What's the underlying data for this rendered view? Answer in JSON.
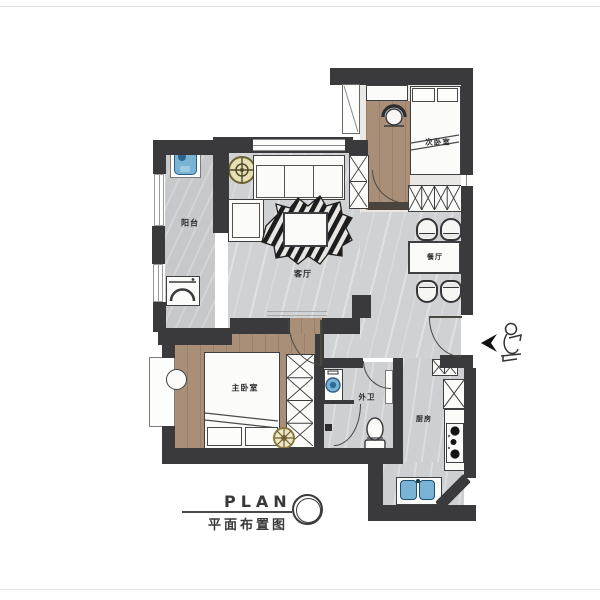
{
  "document": {
    "title": "PLAN",
    "subtitle": "平面布置图"
  },
  "rooms": {
    "balcony": "阳台",
    "living_room": "客厅",
    "second_bedroom": "次卧室",
    "dining_room": "餐厅",
    "master_bedroom": "主卧室",
    "guest_bathroom": "外卫",
    "kitchen": "厨房"
  },
  "fixtures": [
    "laundry-sink",
    "washing-machine",
    "potted-plant",
    "sofa",
    "side-table",
    "coffee-table",
    "zebra-hide-rug",
    "desk",
    "tub-chair",
    "single-bed",
    "wardrobe",
    "shoe-cabinet",
    "dining-table",
    "dining-chair",
    "double-bed",
    "vanity-stool",
    "bath-washer",
    "toilet",
    "storage-shelf",
    "kitchen-cabinet",
    "refrigerator",
    "gas-stove",
    "kitchen-sink",
    "entry-door",
    "entry-figure",
    "duct-shaft"
  ],
  "colors": {
    "wall": "#3a3a3c",
    "wood_floor": "#a98f78",
    "marble_floor": "#d0d1d3",
    "balcony_floor": "#c6c8ca",
    "wet_floor": "#cdcfd1",
    "fixture_blue": "#7ab3d4",
    "plant_gold": "#b7a558",
    "line_dark": "#3d3d3f"
  }
}
